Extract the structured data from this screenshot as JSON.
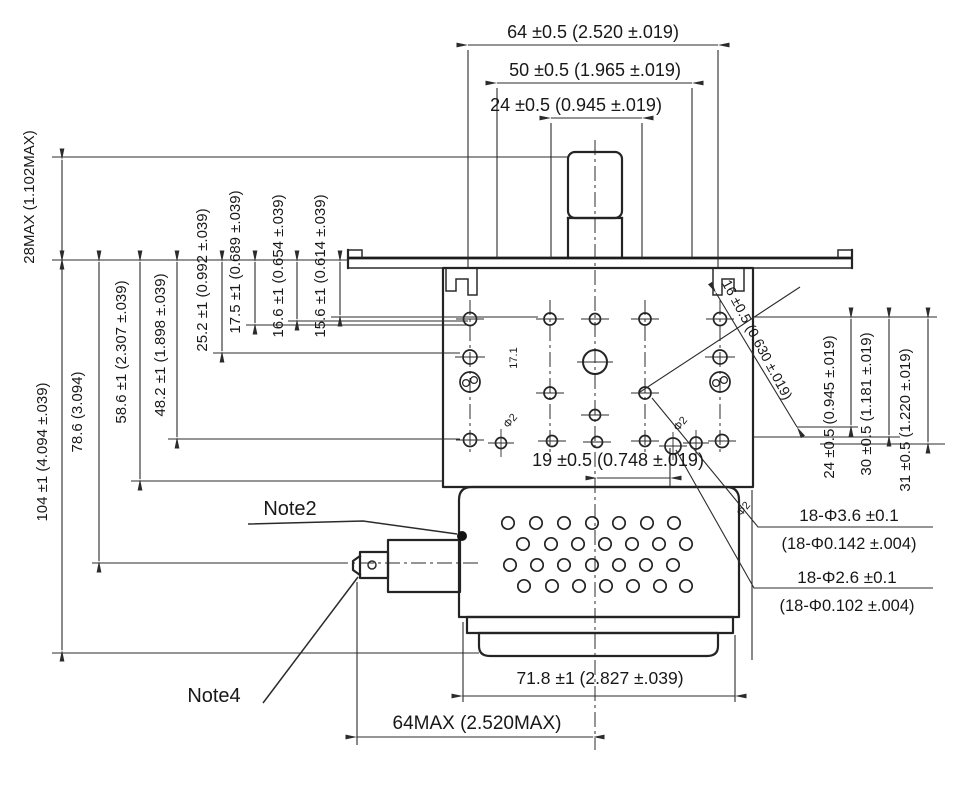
{
  "drawing_type": "engineering dimension drawing (motor / blower unit, top and side features)",
  "colors": {
    "line": "#242424",
    "background": "#ffffff"
  },
  "dims": {
    "top": [
      "64 ±0.5 (2.520 ±.019)",
      "50 ±0.5 (1.965 ±.019)",
      "24 ±0.5 (0.945 ±.019)"
    ],
    "left": [
      "28MAX (1.102MAX)",
      "104 ±1 (4.094 ±.039)",
      "78.6 (3.094)",
      "58.6 ±1 (2.307 ±.039)",
      "48.2 ±1 (1.898 ±.039)",
      "25.2 ±1 (0.992 ±.039)",
      "17.5 ±1 (0.689 ±.039)",
      "16.6 ±1 (0.654 ±.039)",
      "15.6 ±1 (0.614 ±.039)"
    ],
    "right": [
      "24 ±0.5 (0.945 ±.019)",
      "30 ±0.5 (1.181 ±.019)",
      "31 ±0.5 (1.220 ±.019)"
    ],
    "bottom": [
      "71.8 ±1 (2.827 ±.039)",
      "64MAX (2.520MAX)"
    ],
    "inner": [
      "19 ±0.5 (0.748 ±.019)",
      "17.1"
    ],
    "diagonal": "16 ±0.5 (0.630 ±.019)",
    "small_mark": "Φ2"
  },
  "callouts": {
    "holes_large": [
      "18-Φ3.6 ±0.1",
      "(18-Φ0.142 ±.004)"
    ],
    "holes_small": [
      "18-Φ2.6 ±0.1",
      "(18-Φ0.102 ±.004)"
    ]
  },
  "notes": [
    "Note2",
    "Note4"
  ]
}
